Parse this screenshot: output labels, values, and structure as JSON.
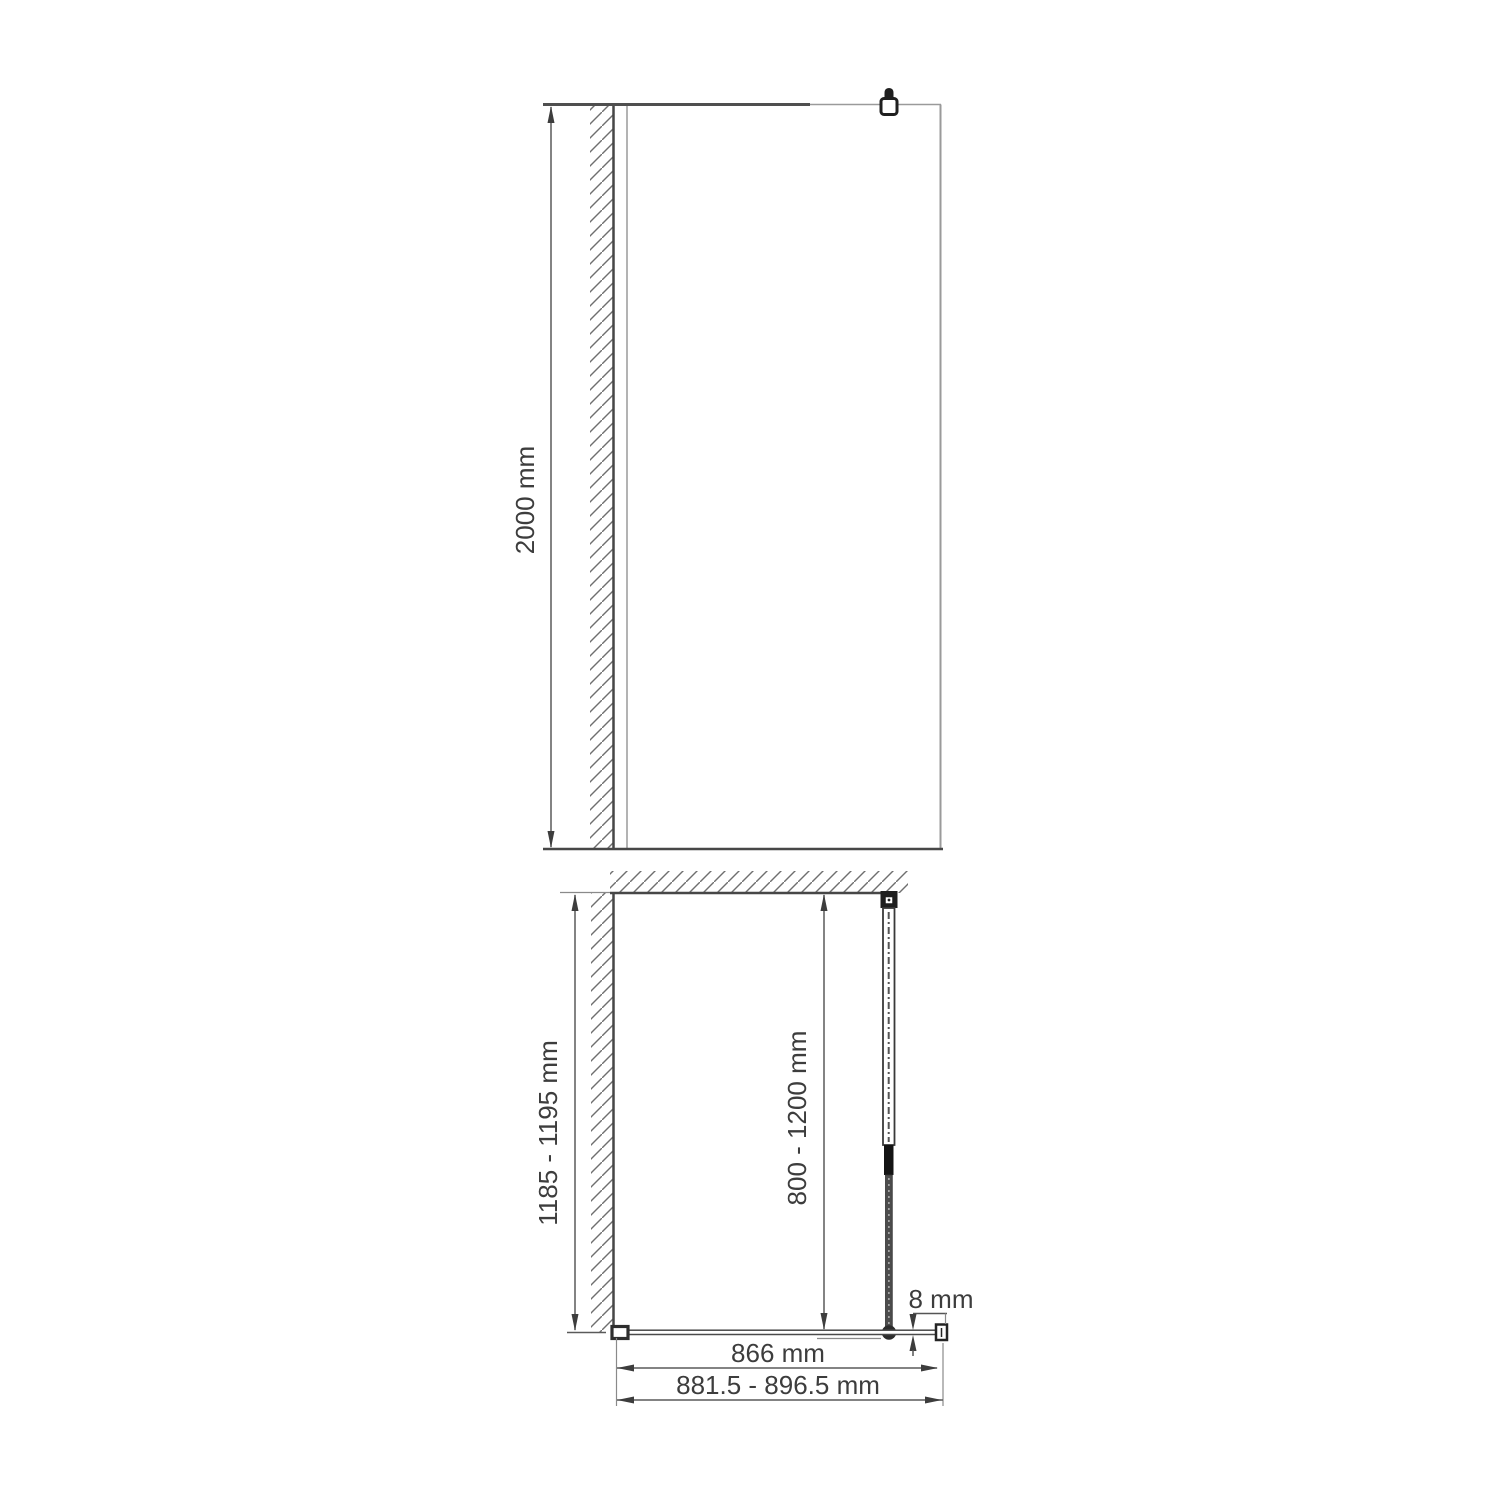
{
  "front_view": {
    "height_label": "2000 mm"
  },
  "plan_view": {
    "depth_label": "1185 - 1195 mm",
    "support_bar_label": "800 - 1200 mm",
    "glass_thickness_label": "8 mm",
    "glass_width_label": "866 mm",
    "overall_width_label": "881.5 - 896.5 mm"
  },
  "colors": {
    "line_dark": "#474747",
    "line_light": "#9a9a9a",
    "text": "#3d3d3d",
    "background": "#ffffff"
  }
}
